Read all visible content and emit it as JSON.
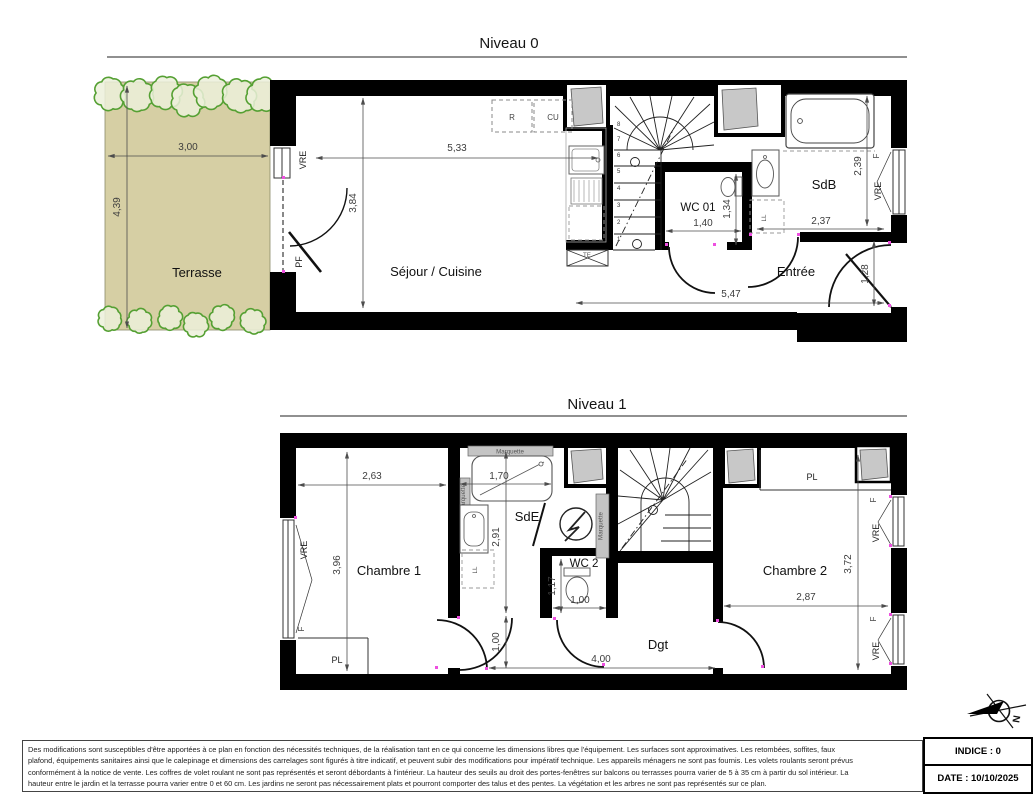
{
  "colors": {
    "wall": "#000000",
    "dimension": "#4d4d4d",
    "terrace_fill": "#d6cfa4",
    "hedge_green": "#55a033",
    "shaft_gray": "#c8c8c8",
    "jamb_magenta": "#ee4fe0"
  },
  "niveau0": {
    "title": "Niveau 0",
    "rooms": {
      "terrasse": "Terrasse",
      "sejour_cuisine": "Séjour / Cuisine",
      "wc": "WC 01",
      "sdb": "SdB",
      "entree": "Entrée"
    },
    "dims": {
      "terrasse_width": "3,00",
      "terrasse_depth": "4,39",
      "sejour_width": "5,33",
      "sejour_depth": "3,84",
      "wc_width": "1,40",
      "wc_depth": "1,34",
      "sdb_depth": "2,39",
      "sdb_width": "2,37",
      "entree_width": "5,47",
      "entree_door": "1,28"
    },
    "tags": {
      "vre_left": "VRE",
      "pf": "PF",
      "fridge": "R",
      "cooktop": "CU",
      "f_right": "F",
      "vre_right": "VRE",
      "te": "TE",
      "ll": "LL"
    },
    "stair_numbers": [
      "1",
      "2",
      "3",
      "4",
      "5",
      "6",
      "7",
      "8"
    ]
  },
  "niveau1": {
    "title": "Niveau 1",
    "rooms": {
      "chambre1": "Chambre 1",
      "sde": "SdE",
      "wc2": "WC 2",
      "dgt": "Dgt",
      "chambre2": "Chambre 2"
    },
    "dims": {
      "chambre1_width": "2,63",
      "chambre1_depth": "3,96",
      "shower_width": "1,70",
      "sde_depth": "2,91",
      "wc2_depth": "1,17",
      "wc2_width": "1,00",
      "chambre1_door": "1,00",
      "dgt_width": "4,00",
      "chambre2_depth": "3,72",
      "chambre2_width": "2,87"
    },
    "tags": {
      "vre_left": "VRE",
      "f_left": "F",
      "pl_chambre1": "PL",
      "pl_chambre2": "PL",
      "marquette_top": "Marquette",
      "marquette_left": "Marquette",
      "marquette_right": "Marquette",
      "f_top_right": "F",
      "vre_top_right": "VRE",
      "f_bottom_right": "F",
      "vre_bottom_right": "VRE",
      "ll": "LL"
    }
  },
  "compass": {
    "north": "N"
  },
  "footer": {
    "lines": [
      "Des modifications sont susceptibles d'être apportées à ce plan en fonction des nécessités techniques, de la réalisation tant en ce qui concerne les dimensions libres que l'équipement. Les surfaces sont approximatives. Les retombées, soffites, faux",
      "plafond, équipements sanitaires ainsi que le calepinage et dimensions des carrelages sont figurés à titre indicatif, et peuvent subir des modifications pour impératif technique. Les appareils ménagers ne sont pas fournis. Les volets roulants seront prévus",
      "conformément à la notice de vente. Les coffres de volet roulant ne sont pas représentés et seront débordants à l'intérieur. La hauteur des seuils au droit des portes-fenêtres sur balcons ou terrasses pourra varier de 5 à 35 cm à partir du sol intérieur. La",
      "hauteur entre le jardin et la terrasse pourra varier entre 0 et 60 cm. Les jardins ne seront pas nécessairement plats et pourront comporter des talus et des pentes. La végétation et les arbres ne sont pas représentés sur ce plan."
    ]
  },
  "titleblock": {
    "indice": "INDICE : 0",
    "date": "DATE : 10/10/2025"
  }
}
